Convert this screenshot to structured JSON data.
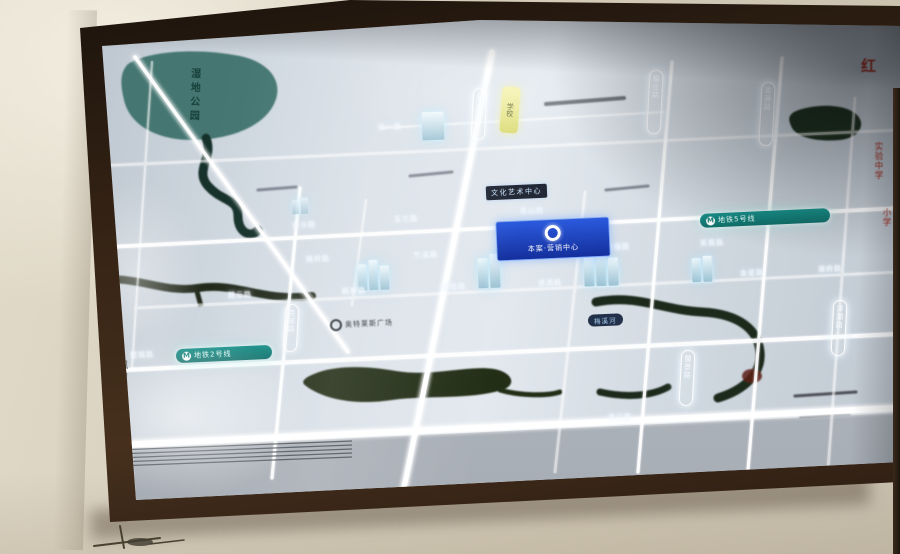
{
  "scene": {
    "type": "photograph of a backlit real-estate location map in a dark wooden wall frame",
    "wall_color": "#d8d0be",
    "frame_color": "#362415",
    "panel_color": "#d2dae2",
    "road_glow_color": "#ffffff",
    "water_color": "#2c4a38",
    "lake_color": "#3a6f69"
  },
  "map": {
    "project_badge": {
      "label": "本案·营销中心",
      "logo": "ring-logo",
      "bg_color": "#1d44c4"
    },
    "metro_badges": [
      {
        "label": "地铁5号线",
        "icon": "metro-M",
        "color": "#13807a"
      },
      {
        "label": "地铁2号线",
        "icon": "metro-M",
        "color": "#13807a"
      }
    ],
    "landmark_labels": {
      "culture_center": "文化艺术中心",
      "plaza": "奥特莱斯广场",
      "river": "梅溪河",
      "park": "湿地公园",
      "lakeside": "凤山湖",
      "school_marker": "学校"
    },
    "red_labels": [
      "红",
      "实验中学",
      "小学"
    ],
    "street_labels": [
      "纬一路",
      "金沙路",
      "玉兰路",
      "青山路",
      "梅岭路",
      "竹溪路",
      "银杉路",
      "紫薇路",
      "芙蓉路",
      "麓云路",
      "枫林路",
      "望岳路",
      "潇湘路",
      "金星路",
      "湘府路",
      "滨江路",
      "望城路"
    ],
    "vertical_road_labels": [
      "观云路",
      "振业路",
      "青莲路",
      "麓景路",
      "洋湖路",
      "连湖路",
      "白云路"
    ]
  }
}
